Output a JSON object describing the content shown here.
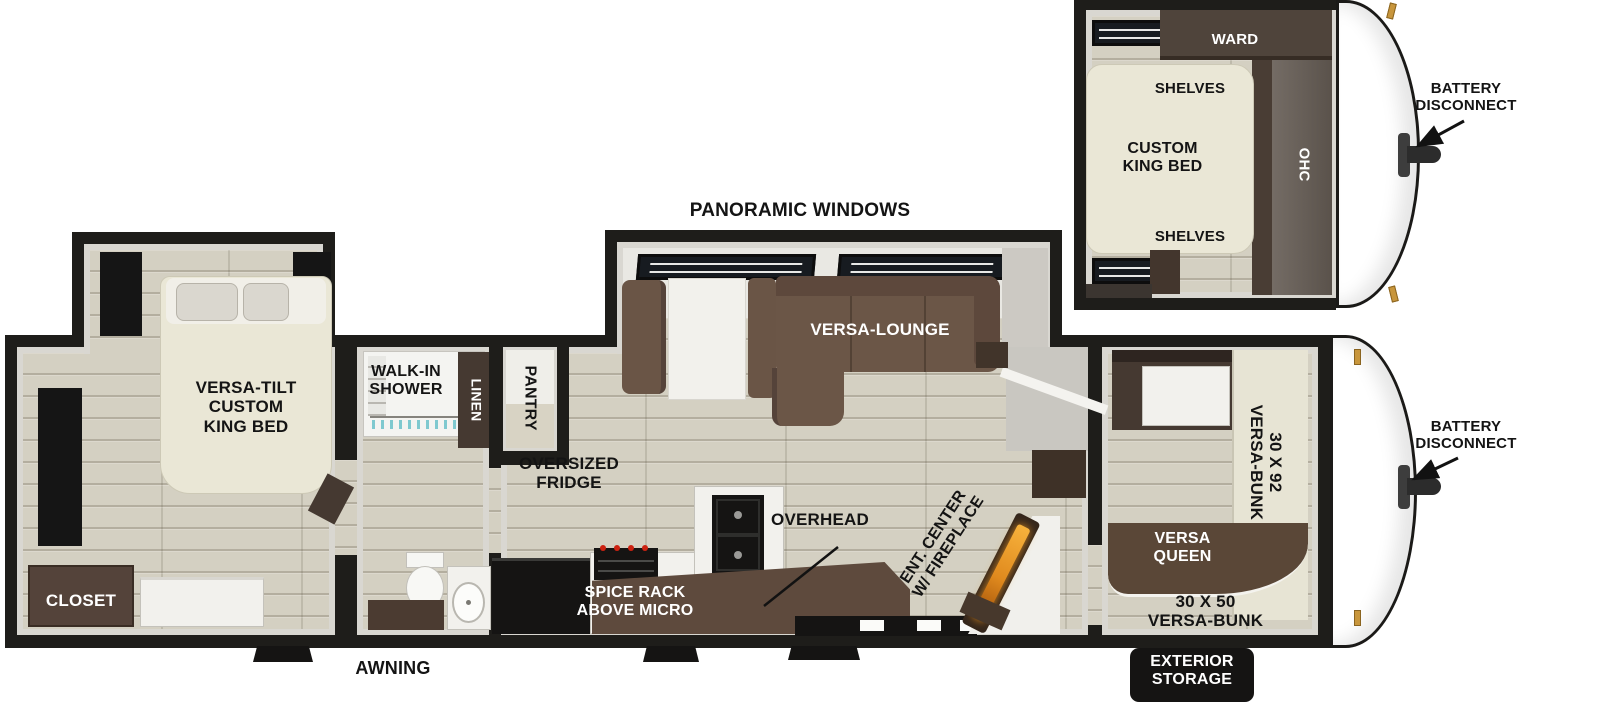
{
  "diagram_type": "travel trailer RV floor plan",
  "colors": {
    "wall": "#1e1d1a",
    "wall_face": "#d9d7d1",
    "floor_wood": "#d4d0c2",
    "bed_cream": "#eae7d6",
    "counter_brown": "#5e4a3d",
    "cabinet_dark_brown": "#453931",
    "sofa_brown": "#6b5647",
    "appliance_black": "#151413",
    "fireplace_orange": "#e08a1e",
    "hinge_gold": "#c8963c",
    "shower_glass_teal": "#7fc9cf"
  },
  "labels": {
    "panoramic_windows": "PANORAMIC WINDOWS",
    "versa_lounge": "VERSA-LOUNGE",
    "versa_tilt_king": "VERSA-TILT\nCUSTOM\nKING BED",
    "closet": "CLOSET",
    "walk_in_shower": "WALK-IN\nSHOWER",
    "linen": "LINEN",
    "pantry": "PANTRY",
    "oversized_fridge": "OVERSIZED\nFRIDGE",
    "spice_rack": "SPICE RACK\nABOVE MICRO",
    "overhead": "OVERHEAD",
    "ent_center": "ENT. CENTER\nW/ FIREPLACE",
    "bunk_30x92": "30 X 92\nVERSA-BUNK",
    "versa_queen": "VERSA\nQUEEN",
    "bunk_30x50": "30 X 50\nVERSA-BUNK",
    "exterior_storage": "EXTERIOR\nSTORAGE",
    "awning": "AWNING",
    "battery_disconnect_front": "BATTERY\nDISCONNECT",
    "battery_disconnect_main": "BATTERY\nDISCONNECT",
    "ward": "WARD",
    "shelves_top": "SHELVES",
    "shelves_bottom": "SHELVES",
    "custom_king_bed": "CUSTOM\nKING BED",
    "ohc": "OHC"
  }
}
